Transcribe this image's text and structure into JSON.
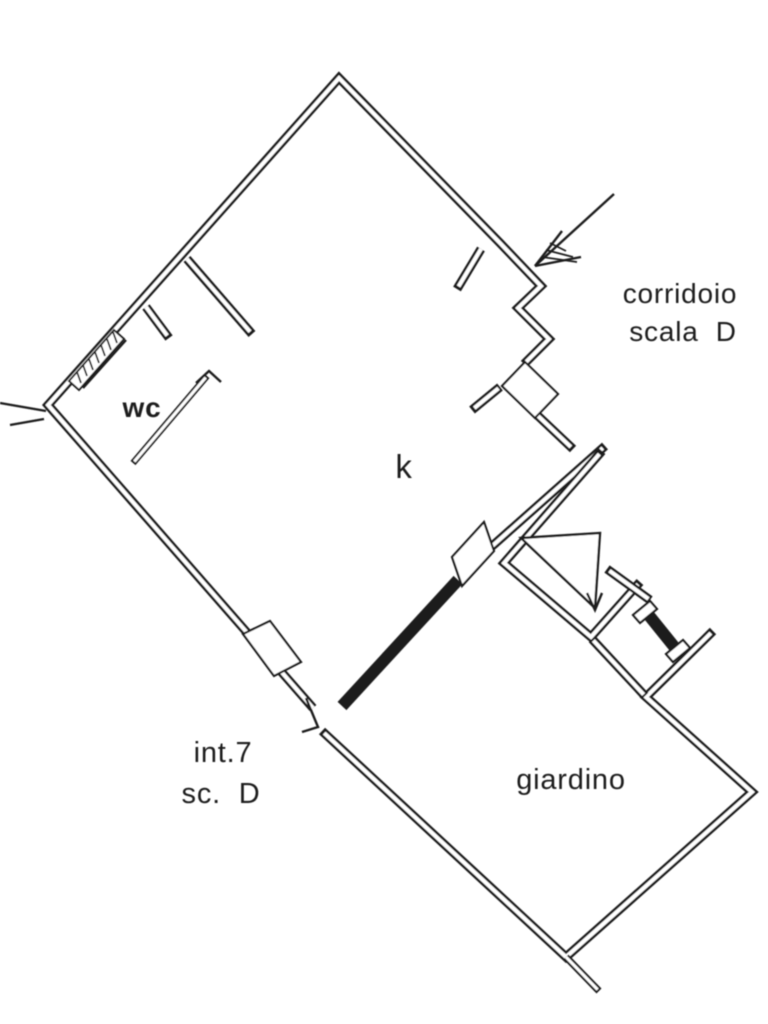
{
  "document": {
    "kind": "scanned architectural floor plan",
    "unit_label": "int.7 sc. D"
  },
  "colors": {
    "ink": "#1f1f1f",
    "paper": "#ffffff"
  },
  "floorplan": {
    "canvas": {
      "w": 768,
      "h": 1024
    },
    "stroke": {
      "wall_black": 9,
      "wall_core": 4,
      "thick": 12,
      "thin": 2.4,
      "hatch": 1.8
    },
    "walls_double": [
      {
        "name": "apartment-outline-wall",
        "pts": [
          [
            524,
            364
          ],
          [
            549,
            339
          ],
          [
            518,
            308
          ],
          [
            541,
            286
          ],
          [
            500,
            243
          ],
          [
            339,
            78
          ],
          [
            48,
            405
          ],
          [
            313,
            708
          ]
        ],
        "i0": 3,
        "i1": 0
      },
      {
        "name": "wc-partition-wall",
        "pts": [
          [
            187,
            259
          ],
          [
            252,
            334
          ]
        ],
        "i0": 0,
        "i1": 3
      },
      {
        "name": "wc-jamb-stub",
        "pts": [
          [
            146,
            307
          ],
          [
            169,
            338
          ]
        ],
        "i0": 0,
        "i1": 3
      },
      {
        "name": "entry-jamb-stub",
        "pts": [
          [
            481,
            249
          ],
          [
            457,
            289
          ]
        ],
        "i0": 0,
        "i1": 3
      },
      {
        "name": "entry-inner-jamb",
        "pts": [
          [
            500,
            387
          ],
          [
            472,
            410
          ]
        ],
        "i0": 2,
        "i1": 3
      },
      {
        "name": "landing-wall",
        "pts": [
          [
            536,
            414
          ],
          [
            573,
            449
          ]
        ],
        "i0": 2,
        "i1": 3
      },
      {
        "name": "se-boundary-wall",
        "pts": [
          [
            490,
            548
          ],
          [
            605,
            446
          ]
        ],
        "i0": 3,
        "i1": 3
      },
      {
        "name": "stair-enclosure-wall",
        "pts": [
          [
            602,
            451
          ],
          [
            504,
            563
          ],
          [
            591,
            637
          ],
          [
            640,
            582
          ]
        ],
        "i0": 4,
        "i1": 3
      },
      {
        "name": "stair-gate-connector",
        "pts": [
          [
            607,
            569
          ],
          [
            650,
            600
          ]
        ],
        "i0": 3,
        "i1": 2
      },
      {
        "name": "giardino-boundary-wall",
        "pts": [
          [
            713,
            631
          ],
          [
            646,
            697
          ],
          [
            752,
            792
          ],
          [
            566,
            957
          ],
          [
            322,
            731
          ]
        ],
        "i0": 3,
        "i1": 3
      },
      {
        "name": "giardino-top-wall",
        "pts": [
          [
            592,
            639
          ],
          [
            645,
            696
          ]
        ],
        "i0": 2,
        "i1": 2
      },
      {
        "name": "giardino-corner-tick",
        "pts": [
          [
            566,
            957
          ],
          [
            599,
            991
          ]
        ],
        "w": 7,
        "wi": 3,
        "i0": 0,
        "i1": 2
      },
      {
        "name": "wc-door-leaf",
        "pts": [
          [
            207,
            376
          ],
          [
            133,
            463
          ]
        ],
        "w": 6.5,
        "wi": 3,
        "i0": 2,
        "i1": 2
      }
    ],
    "walls_thick": [
      {
        "name": "se-hatched-wall",
        "pts": [
          [
            342,
            706
          ],
          [
            458,
            580
          ]
        ]
      },
      {
        "name": "giardino-gate-bar",
        "pts": [
          [
            647,
            613
          ],
          [
            676,
            649
          ]
        ]
      }
    ],
    "blocks": [
      {
        "name": "entry-door-panel",
        "pts": [
          [
            525,
            362
          ],
          [
            558,
            394
          ],
          [
            535,
            418
          ],
          [
            502,
            386
          ]
        ]
      },
      {
        "name": "se-door-block",
        "pts": [
          [
            484,
            522
          ],
          [
            494,
            551
          ],
          [
            462,
            586
          ],
          [
            452,
            557
          ]
        ]
      },
      {
        "name": "sw-door-block",
        "pts": [
          [
            270,
            621
          ],
          [
            301,
            662
          ],
          [
            274,
            676
          ],
          [
            243,
            634
          ]
        ]
      },
      {
        "name": "gate-cap-upper",
        "pts": [
          [
            650,
            601
          ],
          [
            657,
            609
          ],
          [
            640,
            623
          ],
          [
            633,
            615
          ]
        ]
      },
      {
        "name": "gate-cap-lower",
        "pts": [
          [
            683,
            640
          ],
          [
            690,
            648
          ],
          [
            673,
            662
          ],
          [
            666,
            654
          ]
        ]
      }
    ],
    "window": {
      "frame": [
        [
          69,
          381
        ],
        [
          114,
          330
        ],
        [
          124,
          339
        ],
        [
          79,
          390
        ]
      ],
      "hatches": [
        [
          [
            81,
            383
          ],
          [
            77,
            372
          ]
        ],
        [
          [
            87,
            376
          ],
          [
            83,
            365
          ]
        ],
        [
          [
            93,
            370
          ],
          [
            89,
            359
          ]
        ],
        [
          [
            99,
            363
          ],
          [
            95,
            352
          ]
        ],
        [
          [
            105,
            356
          ],
          [
            101,
            345
          ]
        ],
        [
          [
            111,
            350
          ],
          [
            107,
            339
          ]
        ],
        [
          [
            117,
            343
          ],
          [
            113,
            332
          ]
        ]
      ],
      "sill": [
        [
          83,
          388
        ],
        [
          126,
          340
        ]
      ]
    },
    "stairs": {
      "triangle": [
        [
          521,
          538
        ],
        [
          600,
          533
        ],
        [
          595,
          608
        ]
      ],
      "arrowhead": [
        [
          587,
          593
        ],
        [
          595,
          610
        ],
        [
          602,
          593
        ]
      ]
    },
    "entry_arrow": {
      "shaft": [
        [
          614,
          194
        ],
        [
          535,
          266
        ]
      ],
      "barbs": [
        [
          [
            535,
            266
          ],
          [
            562,
            231
          ]
        ],
        [
          [
            535,
            266
          ],
          [
            581,
            257
          ]
        ]
      ],
      "hatches": [
        [
          [
            550,
            243
          ],
          [
            566,
            251
          ]
        ],
        [
          [
            546,
            250
          ],
          [
            573,
            257
          ]
        ],
        [
          [
            542,
            257
          ],
          [
            577,
            262
          ]
        ]
      ]
    },
    "thin_lines": [
      {
        "name": "left-corner-tick-a",
        "pts": [
          [
            0,
            403
          ],
          [
            46,
            411
          ]
        ]
      },
      {
        "name": "left-corner-tick-b",
        "pts": [
          [
            10,
            425
          ],
          [
            44,
            419
          ]
        ]
      },
      {
        "name": "bottom-corner-tick",
        "pts": [
          [
            306,
            698
          ],
          [
            318,
            727
          ],
          [
            302,
            732
          ]
        ]
      },
      {
        "name": "wc-door-tick",
        "pts": [
          [
            196,
            383
          ],
          [
            209,
            371
          ],
          [
            221,
            382
          ]
        ]
      }
    ],
    "labels": [
      {
        "id": "label-corridoio",
        "text": "corridoio",
        "x": 680,
        "y": 303,
        "size": 28,
        "weight": 500
      },
      {
        "id": "label-scala-d",
        "text": "scala  D",
        "x": 683,
        "y": 341,
        "size": 28,
        "weight": 500
      },
      {
        "id": "label-wc",
        "text": "wc",
        "x": 142,
        "y": 417,
        "size": 28,
        "weight": 700
      },
      {
        "id": "label-k",
        "text": "k",
        "x": 404,
        "y": 478,
        "size": 33,
        "weight": 500
      },
      {
        "id": "label-int7",
        "text": "int.7",
        "x": 223,
        "y": 762,
        "size": 29,
        "weight": 500
      },
      {
        "id": "label-sc-d",
        "text": "sc.  D",
        "x": 221,
        "y": 803,
        "size": 29,
        "weight": 500
      },
      {
        "id": "label-giardino",
        "text": "giardino",
        "x": 571,
        "y": 789,
        "size": 29,
        "weight": 500
      }
    ]
  }
}
